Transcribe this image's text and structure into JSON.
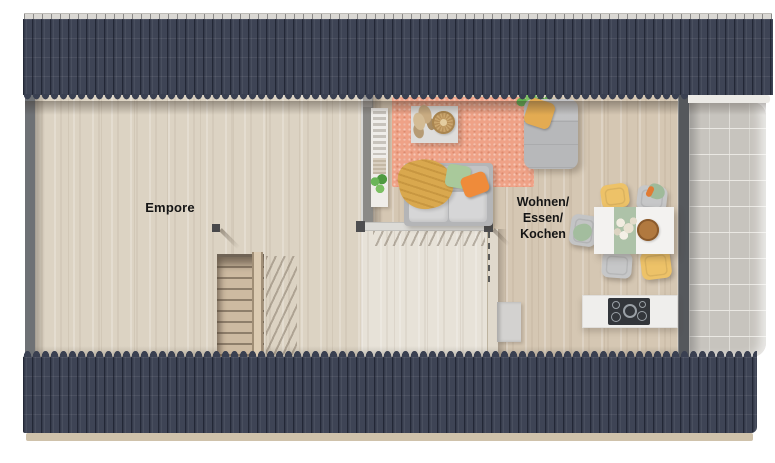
{
  "plan": {
    "type": "architectural-floor-plan",
    "level": "attic",
    "labels": {
      "empore": "Empore",
      "living_lines": [
        "Wohnen/",
        "Essen/",
        "Kochen"
      ]
    },
    "palette": {
      "background": "#ffffff",
      "roof": "#3e4455",
      "roof_rib": "#2e3344",
      "ridge_cap": "#dad8d4",
      "wall_gable": "#6e7175",
      "wall_dark_right": "#55585c",
      "wall_light": "#e0d9cc",
      "floor_empore": "#dcd3c3",
      "floor_living": "#d5c7b3",
      "floor_landing": "#e7e2d8",
      "balcony_tile": "#c7c4be",
      "eave": "#cfc2ab",
      "rug_salmon": "#efa287",
      "sofa_gray": "#b4b5b7",
      "blanket_mustard": "#d9a84e",
      "pillow_green": "#a9c99b",
      "pillow_orange": "#ef8b3a",
      "chair_yellow": "#edc268",
      "chair_gray": "#c6c7c8",
      "table_white": "#f3f2f0",
      "runner_sage": "#adc2a8",
      "counter_white": "#efeeec",
      "cooktop_dark": "#33363b",
      "stair_wood": "#cdbaa1",
      "plant_green": "#5fae4e"
    },
    "objects": {
      "rooms": [
        "Empore",
        "Wohnen/Essen/Kochen",
        "Balkon"
      ],
      "furniture": [
        "staircase",
        "stair-railing",
        "gallery-railing",
        "bookshelf",
        "rug",
        "coffee-table",
        "decor-tray",
        "pampas-plant",
        "sofa",
        "blanket",
        "pillows",
        "chaise-lounge",
        "corner-plant",
        "dining-table",
        "table-runner",
        "flower-bouquet",
        "food-plate",
        "dining-chairs",
        "kitchen-counter",
        "cooktop",
        "tall-cabinet"
      ]
    }
  }
}
